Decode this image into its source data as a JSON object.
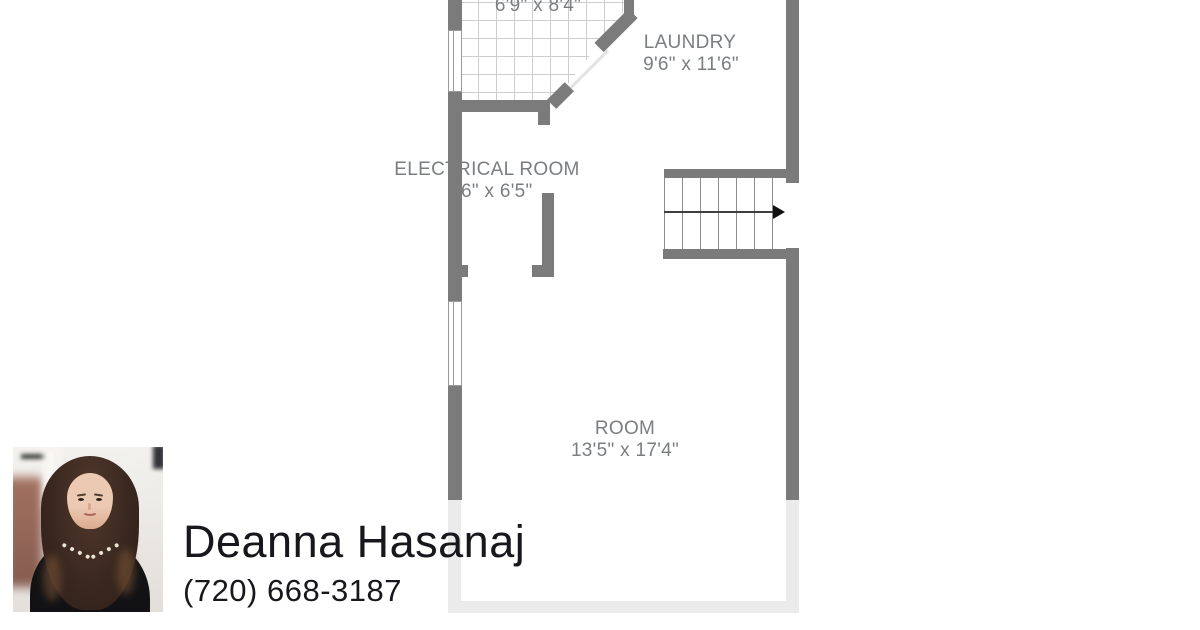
{
  "page": {
    "background": "#ffffff"
  },
  "floorplan": {
    "rooms": {
      "top_room": {
        "dims": "6'9\" x 8'4\""
      },
      "laundry": {
        "label": "LAUNDRY",
        "dims": "9'6\" x 11'6\""
      },
      "electrical_room": {
        "label": "ELECTRICAL ROOM",
        "dims": "6\" x 6'5\""
      },
      "room": {
        "label": "ROOM",
        "dims": "13'5\" x 17'4\""
      }
    },
    "colors": {
      "wall": "#7b7b7b",
      "wall_faded": "#ebebeb",
      "room_label": "#7b7e81",
      "tile_grid": "#cdcdcd",
      "stair_tread": "#8d8d8d",
      "stair_arrow": "#1a1a1a"
    }
  },
  "agent": {
    "name": "Deanna Hasanaj",
    "phone": "(720) 668-3187",
    "text_color": "#17171d"
  }
}
